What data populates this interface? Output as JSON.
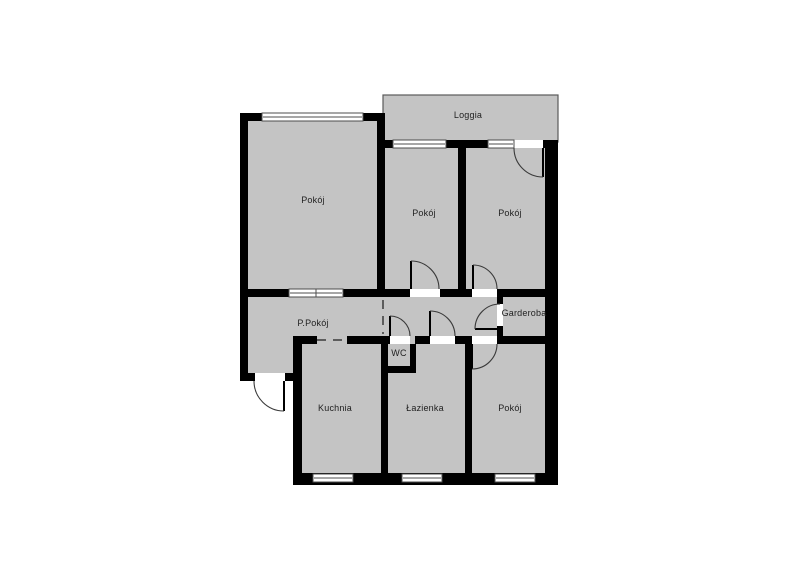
{
  "plan": {
    "type": "apartment-floor-plan",
    "colors": {
      "background": "#ffffff",
      "floor": "#c4c4c4",
      "wall": "#000000",
      "window_fill": "#ffffff",
      "window_stroke": "#4d4d4d",
      "door_arc": "#3a3a3a",
      "dashed_opening": "#3a3a3a",
      "loggia_stroke": "#5a5a5a",
      "label": "#1f1f1f"
    },
    "rooms": [
      {
        "id": "loggia",
        "label": "Loggia"
      },
      {
        "id": "room-top-left",
        "label": "Pokój"
      },
      {
        "id": "room-top-middle",
        "label": "Pokój"
      },
      {
        "id": "room-top-right",
        "label": "Pokój"
      },
      {
        "id": "hallway",
        "label": "P.Pokój"
      },
      {
        "id": "garderoba",
        "label": "Garderoba"
      },
      {
        "id": "wc",
        "label": "WC"
      },
      {
        "id": "kuchnia",
        "label": "Kuchnia"
      },
      {
        "id": "lazienka",
        "label": "Łazienka"
      },
      {
        "id": "room-bottom-right",
        "label": "Pokój"
      }
    ]
  }
}
